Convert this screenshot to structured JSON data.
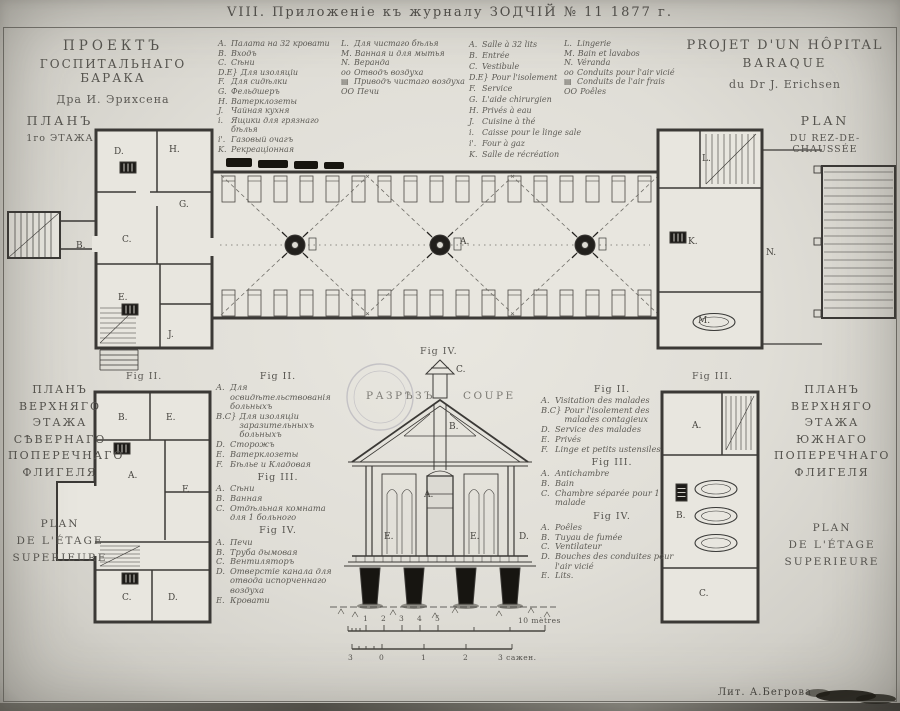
{
  "header": {
    "title": "VIII. Приложеніе къ журналу ЗОДЧІЙ № 11 1877 г."
  },
  "titles": {
    "ru": {
      "l1": "ПРОЕКТЪ",
      "l2": "ГОСПИТАЛЬНАГО БАРАКА",
      "l3": "Дра И. Эрихсена"
    },
    "ru_plan": {
      "l1": "ПЛАНЪ",
      "l2": "1го ЭТАЖА"
    },
    "fr": {
      "l1": "PROJET D'UN HÔPITAL",
      "l2": "BARAQUE",
      "l3": "du Dr J. Erichsen"
    },
    "fr_plan": {
      "l1": "PLAN",
      "l2": "DU REZ-DE-CHAUSSÉE"
    }
  },
  "legend_main": {
    "ru_col1": [
      {
        "k": "A.",
        "t": "Палата на 32 кровати"
      },
      {
        "k": "B.",
        "t": "Входъ"
      },
      {
        "k": "C.",
        "t": "Сѣни"
      },
      {
        "k": "D.E}",
        "t": "Для изоляціи"
      },
      {
        "k": "F.",
        "t": "Для сидѣлки"
      },
      {
        "k": "G.",
        "t": "Фельдшеръ"
      },
      {
        "k": "H.",
        "t": "Ватерклозеты"
      },
      {
        "k": "J.",
        "t": "Чайная кухня"
      },
      {
        "k": "i.",
        "t": "Ящики для грязнаго бѣлья"
      },
      {
        "k": "i'.",
        "t": "Газовый очагъ"
      },
      {
        "k": "K.",
        "t": "Рекреаціонная"
      }
    ],
    "ru_col2": [
      {
        "k": "L.",
        "t": "Для чистаго бѣлья"
      },
      {
        "k": "M.",
        "t": "Ванная и для мытья"
      },
      {
        "k": "N.",
        "t": "Веранда"
      },
      {
        "k": "oo",
        "t": "Отводъ воздуха"
      },
      {
        "k": "▤",
        "t": "Приводъ чистаго воздуха"
      },
      {
        "k": "OO",
        "t": "Печи"
      }
    ],
    "fr_col1": [
      {
        "k": "A.",
        "t": "Salle à 32 lits"
      },
      {
        "k": "B.",
        "t": "Entrée"
      },
      {
        "k": "C.",
        "t": "Vestibule"
      },
      {
        "k": "D.E}",
        "t": "Pour l'isolement"
      },
      {
        "k": "F.",
        "t": "Service"
      },
      {
        "k": "G.",
        "t": "L'aide chirurgien"
      },
      {
        "k": "H.",
        "t": "Privés à eau"
      },
      {
        "k": "J.",
        "t": "Cuisine à thé"
      },
      {
        "k": "i.",
        "t": "Caisse pour le linge sale"
      },
      {
        "k": "i'.",
        "t": "Four à gaz"
      },
      {
        "k": "K.",
        "t": "Salle de récréation"
      }
    ],
    "fr_col2": [
      {
        "k": "L.",
        "t": "Lingerie"
      },
      {
        "k": "M.",
        "t": "Bain et lavabos"
      },
      {
        "k": "N.",
        "t": "Véranda"
      },
      {
        "k": "oo",
        "t": "Conduits pour l'air vicié"
      },
      {
        "k": "▤",
        "t": "Conduits de l'air frais"
      },
      {
        "k": "OO",
        "t": "Poêles"
      }
    ]
  },
  "captions": {
    "fig2": "Fig II.",
    "fig3": "Fig III.",
    "fig4": "Fig IV.",
    "section_ru": "РАЗРѢЗЪ",
    "section_fr": "COUPE"
  },
  "legend_fig_ru": {
    "fig2_title": "Fig II.",
    "fig2": [
      {
        "k": "A.",
        "t": "Для освидѣтельствованія больныхъ"
      },
      {
        "k": "B.C}",
        "t": "Для изоляціи заразительныхъ больныхъ"
      },
      {
        "k": "D.",
        "t": "Сторожъ"
      },
      {
        "k": "E.",
        "t": "Ватерклозеты"
      },
      {
        "k": "F.",
        "t": "Бѣлье и Кладовая"
      }
    ],
    "fig3_title": "Fig III.",
    "fig3": [
      {
        "k": "A.",
        "t": "Сѣни"
      },
      {
        "k": "B.",
        "t": "Ванная"
      },
      {
        "k": "C.",
        "t": "Отдѣльная комната для 1 больного"
      }
    ],
    "fig4_title": "Fig IV.",
    "fig4": [
      {
        "k": "A.",
        "t": "Печи"
      },
      {
        "k": "B.",
        "t": "Труба дымовая"
      },
      {
        "k": "C.",
        "t": "Вентиляторъ"
      },
      {
        "k": "D.",
        "t": "Отверстіе канала для отвода испорченнаго воздуха"
      },
      {
        "k": "E.",
        "t": "Кровати"
      }
    ]
  },
  "legend_fig_fr": {
    "fig2_title": "Fig II.",
    "fig2": [
      {
        "k": "A.",
        "t": "Visitation des malades"
      },
      {
        "k": "B.C}",
        "t": "Pour l'isolement des malades contagieux"
      },
      {
        "k": "D.",
        "t": "Service des malades"
      },
      {
        "k": "E.",
        "t": "Privés"
      },
      {
        "k": "F.",
        "t": "Linge et petits ustensiles"
      }
    ],
    "fig3_title": "Fig III.",
    "fig3": [
      {
        "k": "A.",
        "t": "Antichambre"
      },
      {
        "k": "B.",
        "t": "Bain"
      },
      {
        "k": "C.",
        "t": "Chambre séparée pour 1 malade"
      }
    ],
    "fig4_title": "Fig IV.",
    "fig4": [
      {
        "k": "A.",
        "t": "Poêles"
      },
      {
        "k": "B.",
        "t": "Tuyau de fumée"
      },
      {
        "k": "C.",
        "t": "Ventilateur"
      },
      {
        "k": "D.",
        "t": "Bouches des conduites pour l'air vicié"
      },
      {
        "k": "E.",
        "t": "Lits."
      }
    ]
  },
  "side_titles": {
    "left": {
      "lines": [
        "ПЛАНЪ",
        "ВЕРХНЯГО",
        "ЭТАЖА",
        "СѢВЕРНАГО",
        "ПОПЕРЕЧНАГО",
        "ФЛИГЕЛЯ"
      ],
      "sub": [
        "PLAN",
        "DE L'ÉTAGE",
        "SUPERIEURE"
      ]
    },
    "right": {
      "lines": [
        "ПЛАНЪ",
        "ВЕРХНЯГО",
        "ЭТАЖА",
        "ЮЖНАГО",
        "ПОПЕРЕЧНАГО",
        "ФЛИГЕЛЯ"
      ],
      "sub": [
        "PLAN",
        "DE L'ÉTAGE",
        "SUPERIEURE"
      ]
    }
  },
  "pos_labels": {
    "ground": [
      {
        "t": "D.",
        "x": 114,
        "y": 147
      },
      {
        "t": "H.",
        "x": 169,
        "y": 145
      },
      {
        "t": "G.",
        "x": 179,
        "y": 200
      },
      {
        "t": "C.",
        "x": 122,
        "y": 235
      },
      {
        "t": "B.",
        "x": 76,
        "y": 241
      },
      {
        "t": "E.",
        "x": 118,
        "y": 293
      },
      {
        "t": "J.",
        "x": 168,
        "y": 330
      },
      {
        "t": "A.",
        "x": 460,
        "y": 237
      },
      {
        "t": "K.",
        "x": 688,
        "y": 237
      },
      {
        "t": "L.",
        "x": 702,
        "y": 154
      },
      {
        "t": "M.",
        "x": 698,
        "y": 316
      },
      {
        "t": "N.",
        "x": 766,
        "y": 248
      }
    ],
    "fig2": [
      {
        "t": "B.",
        "x": 118,
        "y": 413
      },
      {
        "t": "E.",
        "x": 166,
        "y": 413
      },
      {
        "t": "A.",
        "x": 128,
        "y": 471
      },
      {
        "t": "F.",
        "x": 182,
        "y": 485
      },
      {
        "t": "C.",
        "x": 122,
        "y": 593
      },
      {
        "t": "D.",
        "x": 168,
        "y": 593
      }
    ],
    "fig3": [
      {
        "t": "A.",
        "x": 692,
        "y": 421
      },
      {
        "t": "B.",
        "x": 676,
        "y": 511
      },
      {
        "t": "C.",
        "x": 699,
        "y": 589
      }
    ],
    "section": [
      {
        "t": "C.",
        "x": 456,
        "y": 365
      },
      {
        "t": "B.",
        "x": 449,
        "y": 422
      },
      {
        "t": "A.",
        "x": 424,
        "y": 490
      },
      {
        "t": "E.",
        "x": 384,
        "y": 532
      },
      {
        "t": "E.",
        "x": 470,
        "y": 532
      },
      {
        "t": "D.",
        "x": 519,
        "y": 532
      }
    ]
  },
  "scale": {
    "metres_ticks": [
      {
        "t": "1",
        "x": 363,
        "y": 614
      },
      {
        "t": "2",
        "x": 381,
        "y": 614
      },
      {
        "t": "3",
        "x": 399,
        "y": 614
      },
      {
        "t": "4",
        "x": 417,
        "y": 614
      },
      {
        "t": "5",
        "x": 435,
        "y": 614
      },
      {
        "t": "10 mètres",
        "x": 518,
        "y": 616
      }
    ],
    "sazhen_ticks": [
      {
        "t": "3",
        "x": 348,
        "y": 653
      },
      {
        "t": "0",
        "x": 379,
        "y": 653
      },
      {
        "t": "1",
        "x": 421,
        "y": 653
      },
      {
        "t": "2",
        "x": 463,
        "y": 653
      },
      {
        "t": "3 сажен.",
        "x": 498,
        "y": 653
      }
    ]
  },
  "credit": {
    "text": "Лит. А.Бегрова"
  },
  "colors": {
    "paper": "#e3e1da",
    "room_fill": "#e8e6df",
    "ink": "#3b3936",
    "faint_ink": "#7c7a74",
    "stamp": "#8f8da0"
  }
}
